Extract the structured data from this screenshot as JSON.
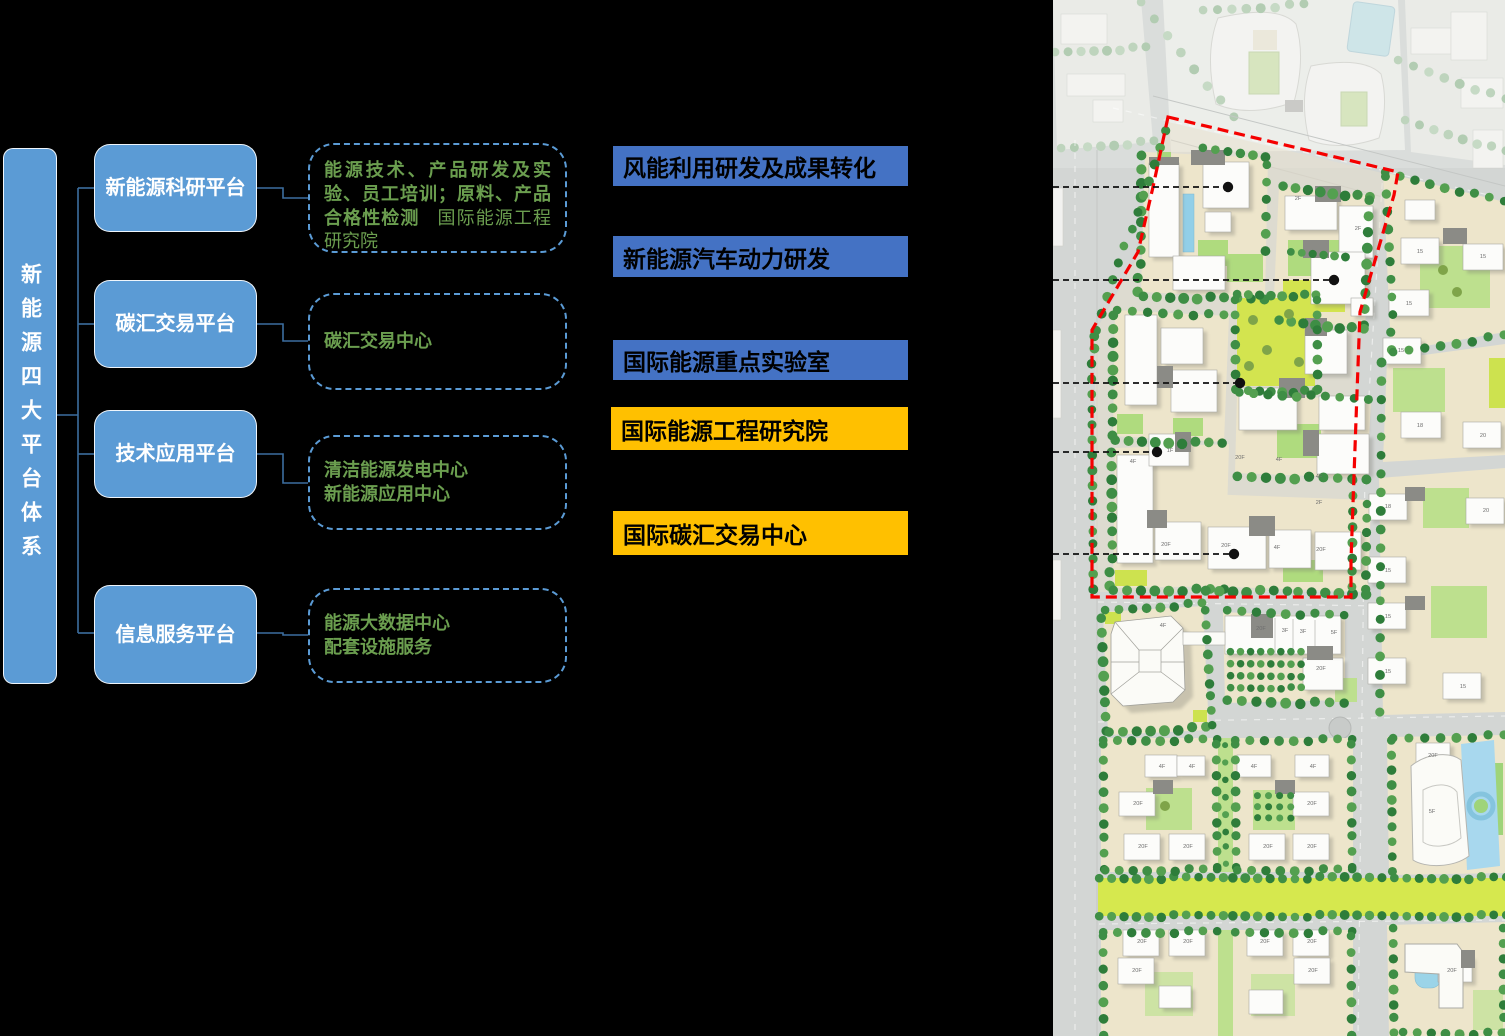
{
  "diagram": {
    "root": {
      "label": "新能源四大平台体系"
    },
    "platforms": [
      {
        "label": "新能源科研平台",
        "detail_bold": "能源技术、产品研发及实验、员工培训；原料、产品合格性检测",
        "detail_regular": "国际能源工程研究院"
      },
      {
        "label": "碳汇交易平台",
        "detail": "碳汇交易中心"
      },
      {
        "label": "技术应用平台",
        "detail": "清洁能源发电中心\n新能源应用中心"
      },
      {
        "label": "信息服务平台",
        "detail": "能源大数据中心\n配套设施服务"
      }
    ],
    "colors": {
      "platform_box": "#5B9BD5",
      "connector": "#3C6E9F",
      "detail_text": "#6B9E4F",
      "dashed_border": "#5B9BD5"
    }
  },
  "callouts": [
    {
      "label": "风能利用研发及成果转化",
      "color": "#4472C4"
    },
    {
      "label": "新能源汽车动力研发",
      "color": "#4472C4"
    },
    {
      "label": "国际能源重点实验室",
      "color": "#4472C4"
    },
    {
      "label": "国际能源工程研究院",
      "color": "#FFC000"
    },
    {
      "label": "国际碳汇交易中心",
      "color": "#FFC000"
    }
  ],
  "map": {
    "boundary_color": "#F50000",
    "leader_color": "#111111",
    "label_color": "#6E6E6E",
    "leaders": [
      {
        "y": 187,
        "x2": 175
      },
      {
        "y": 280,
        "x2": 281
      },
      {
        "y": 383,
        "x2": 187
      },
      {
        "y": 452,
        "x2": 104
      },
      {
        "y": 554,
        "x2": 181
      }
    ],
    "building_labels": [
      {
        "t": "2F",
        "x": 245,
        "y": 200
      },
      {
        "t": "2F",
        "x": 305,
        "y": 230
      },
      {
        "t": "20F",
        "x": 187,
        "y": 459
      },
      {
        "t": "4F",
        "x": 226,
        "y": 461
      },
      {
        "t": "4F",
        "x": 266,
        "y": 478
      },
      {
        "t": "2F",
        "x": 266,
        "y": 504
      },
      {
        "t": "4F",
        "x": 80,
        "y": 463
      },
      {
        "t": "1F",
        "x": 117,
        "y": 452
      },
      {
        "t": "20F",
        "x": 113,
        "y": 546
      },
      {
        "t": "20F",
        "x": 173,
        "y": 547
      },
      {
        "t": "4F",
        "x": 224,
        "y": 549
      },
      {
        "t": "20F",
        "x": 268,
        "y": 551
      },
      {
        "t": "4F",
        "x": 110,
        "y": 627
      },
      {
        "t": "20F",
        "x": 208,
        "y": 630
      },
      {
        "t": "3F",
        "x": 232,
        "y": 632
      },
      {
        "t": "3F",
        "x": 250,
        "y": 633
      },
      {
        "t": "5F",
        "x": 281,
        "y": 634
      },
      {
        "t": "20F",
        "x": 268,
        "y": 670
      },
      {
        "t": "15",
        "x": 367,
        "y": 253
      },
      {
        "t": "15",
        "x": 430,
        "y": 258
      },
      {
        "t": "15",
        "x": 356,
        "y": 305
      },
      {
        "t": "15",
        "x": 348,
        "y": 352
      },
      {
        "t": "18",
        "x": 367,
        "y": 427
      },
      {
        "t": "20",
        "x": 430,
        "y": 437
      },
      {
        "t": "18",
        "x": 335,
        "y": 508
      },
      {
        "t": "20",
        "x": 433,
        "y": 512
      },
      {
        "t": "15",
        "x": 335,
        "y": 572
      },
      {
        "t": "15",
        "x": 335,
        "y": 618
      },
      {
        "t": "15",
        "x": 335,
        "y": 673
      },
      {
        "t": "15",
        "x": 410,
        "y": 688
      },
      {
        "t": "20F",
        "x": 380,
        "y": 757
      },
      {
        "t": "5F",
        "x": 379,
        "y": 813
      },
      {
        "t": "4F",
        "x": 109,
        "y": 768
      },
      {
        "t": "4F",
        "x": 139,
        "y": 768
      },
      {
        "t": "20F",
        "x": 85,
        "y": 805
      },
      {
        "t": "20F",
        "x": 90,
        "y": 848
      },
      {
        "t": "20F",
        "x": 135,
        "y": 848
      },
      {
        "t": "4F",
        "x": 201,
        "y": 768
      },
      {
        "t": "4F",
        "x": 260,
        "y": 768
      },
      {
        "t": "20F",
        "x": 259,
        "y": 805
      },
      {
        "t": "20F",
        "x": 215,
        "y": 848
      },
      {
        "t": "20F",
        "x": 259,
        "y": 848
      },
      {
        "t": "20F",
        "x": 89,
        "y": 943
      },
      {
        "t": "20F",
        "x": 135,
        "y": 943
      },
      {
        "t": "20F",
        "x": 84,
        "y": 972
      },
      {
        "t": "20F",
        "x": 212,
        "y": 943
      },
      {
        "t": "20F",
        "x": 259,
        "y": 943
      },
      {
        "t": "20F",
        "x": 260,
        "y": 972
      },
      {
        "t": "20F",
        "x": 399,
        "y": 972
      }
    ]
  }
}
